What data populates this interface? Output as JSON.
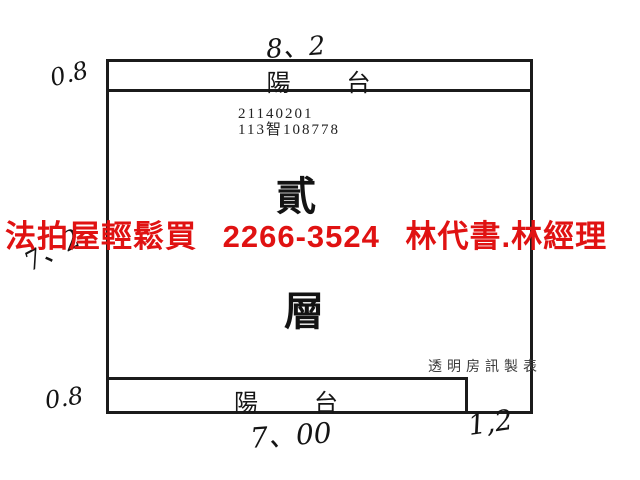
{
  "page": {
    "background": "#ffffff",
    "line_color": "#1b1b1b"
  },
  "floorplan": {
    "top_balcony": {
      "label": "陽 台"
    },
    "bottom_balcony": {
      "label": "陽 台"
    },
    "case_id": {
      "line1": "21140201",
      "line2": "113智108778"
    },
    "floor_label": {
      "char1": "貳",
      "char2": "層"
    },
    "maker_credit": "透明房訊製表"
  },
  "handwritten_measurements": {
    "top_width": "8、2",
    "upper_left_depth": "0.8",
    "left_height": "7、2",
    "lower_left_depth": "0.8",
    "bottom_width": "7、00",
    "bottom_right_width": "1,2"
  },
  "ad_overlay": {
    "text": "法拍屋輕鬆買 2266-3524 林代書.林經理",
    "color": "#e01212"
  }
}
